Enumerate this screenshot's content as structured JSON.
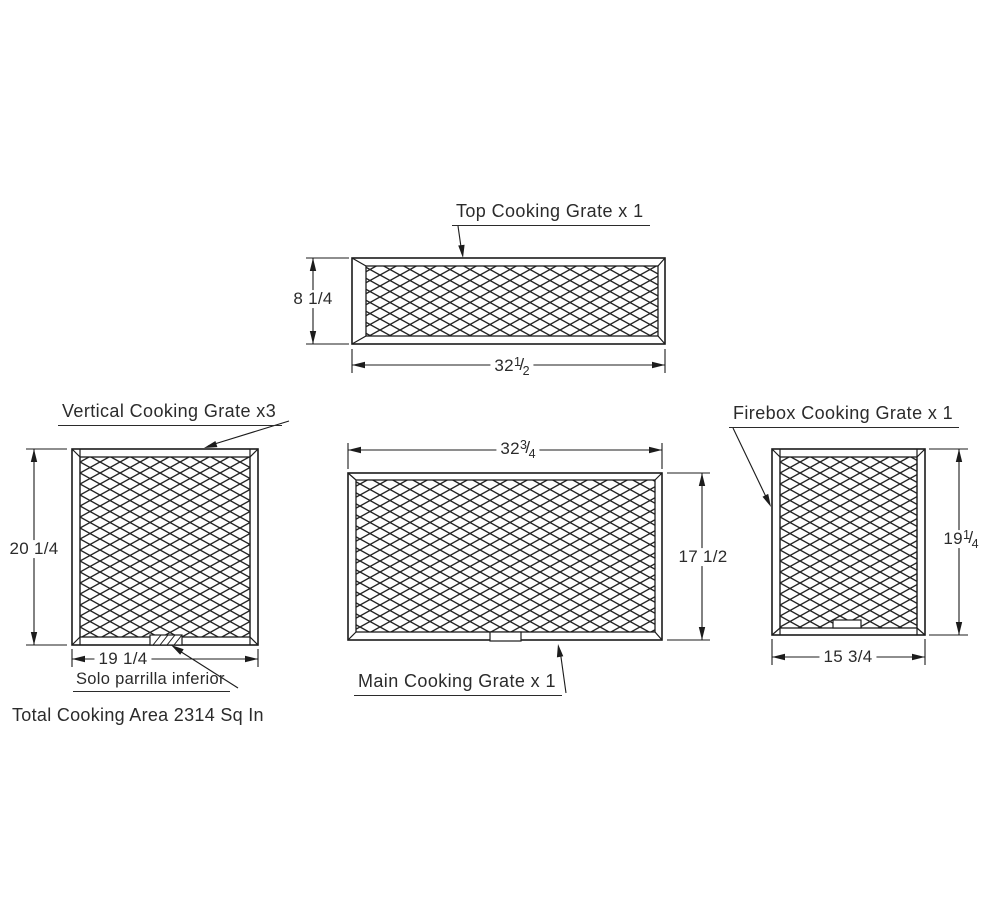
{
  "drawing": {
    "total_note": "Total Cooking Area 2314 Sq In",
    "top_grate": {
      "label": "Top Cooking Grate x 1",
      "height": "8 1/4",
      "width_whole": "32",
      "width_numerator": "1",
      "width_denominator": "2"
    },
    "vertical_grate": {
      "label": "Vertical Cooking Grate x3",
      "height": "20 1/4",
      "width": "19 1/4",
      "note": "Solo parrilla inferior"
    },
    "main_grate": {
      "label": "Main Cooking Grate x 1",
      "width_whole": "32",
      "width_numerator": "3",
      "width_denominator": "4",
      "height": "17 1/2"
    },
    "firebox_grate": {
      "label": "Firebox Cooking Grate x 1",
      "height_whole": "19",
      "height_numerator": "1",
      "height_denominator": "4",
      "width": "15 3/4"
    }
  },
  "glyphs": {
    "fraction_slash": "/"
  }
}
